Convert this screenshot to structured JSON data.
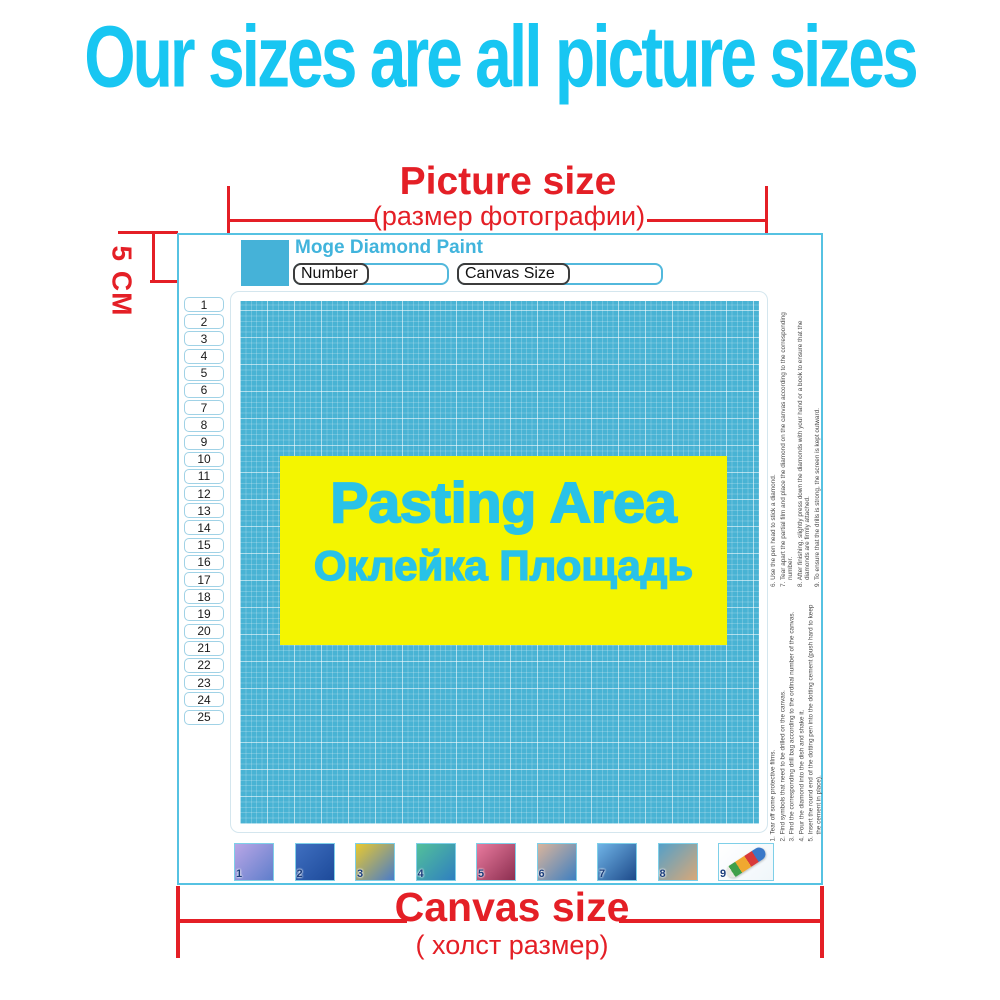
{
  "title": "Our sizes are all picture sizes",
  "picture_size": {
    "label": "Picture size",
    "sublabel": "(размер фотографии)"
  },
  "margin_label": "5 CM",
  "canvas_size": {
    "label": "Canvas size",
    "sublabel": "( холст размер)"
  },
  "mockup": {
    "brand": "Moge Diamond Paint",
    "fields": {
      "number_label": "Number",
      "canvas_size_label": "Canvas Size"
    },
    "pasting_area": {
      "en": "Pasting Area",
      "ru": "Оклейка Площадь"
    }
  },
  "row_numbers": [
    "1",
    "2",
    "3",
    "4",
    "5",
    "6",
    "7",
    "8",
    "9",
    "10",
    "11",
    "12",
    "13",
    "14",
    "15",
    "16",
    "17",
    "18",
    "19",
    "20",
    "21",
    "22",
    "23",
    "24",
    "25"
  ],
  "instructions_right_top": [
    "6. Use the pen head to stick a diamond.",
    "7. Tear apart the partial film and place the diamond on the canvas according to the corresponding number.",
    "8. After finishing, slightly press down the diamonds with your hand or a book to ensure that the diamonds are firmly attached.",
    "9. To ensure that the drills is strong, the screen is kept outward."
  ],
  "instructions_right_bottom": [
    "1. Tear off some protective films.",
    "2. Find symbols that need to be drilled on the canvas.",
    "3. Find the corresponding drill bag according to the ordinal number of the canvas.",
    "4. Pour the diamond into the dish and shake it.",
    "5. Insert the round end of the dotting pen into the dotting cement (push hard to keep the cement in place)."
  ],
  "steps": [
    {
      "num": "1",
      "desc": "canvas-with-ruler",
      "c1": "#b9a6e6",
      "c2": "#5f7ecb"
    },
    {
      "num": "2",
      "desc": "find-symbols-on-canvas",
      "c1": "#3f6fc0",
      "c2": "#1d4a9a"
    },
    {
      "num": "3",
      "desc": "drill-bag-and-pen-on-canvas",
      "c1": "#e8c830",
      "c2": "#4a7cc8"
    },
    {
      "num": "4",
      "desc": "pour-diamonds-into-tray",
      "c1": "#52c09a",
      "c2": "#2f7fc0"
    },
    {
      "num": "5",
      "desc": "pick-up-diamond-with-pen",
      "c1": "#e87a9e",
      "c2": "#8c2f50"
    },
    {
      "num": "6",
      "desc": "place-diamond-on-canvas",
      "c1": "#d9b49c",
      "c2": "#3f7fc0"
    },
    {
      "num": "7",
      "desc": "fill-canvas-with-diamonds",
      "c1": "#6fb3e6",
      "c2": "#1d4a8a"
    },
    {
      "num": "8",
      "desc": "press-canvas-with-hands",
      "c1": "#55a0c8",
      "c2": "#d8a878"
    },
    {
      "num": "9",
      "desc": "rolled-canvas-tube",
      "c1": "#ffffff",
      "c2": "#f0f6fa",
      "wide": true,
      "tube": true
    }
  ],
  "colors": {
    "title_cyan": "#18c6f2",
    "annotation_red": "#e41f26",
    "grid_blue": "#49b3d4",
    "pasting_yellow": "#f4f500",
    "pasting_text_cyan": "#29c2e8",
    "brand_cyan": "#41b4dc",
    "mockup_border_cyan": "#56c2e2",
    "thumb_number_navy": "#1c3e7c"
  }
}
